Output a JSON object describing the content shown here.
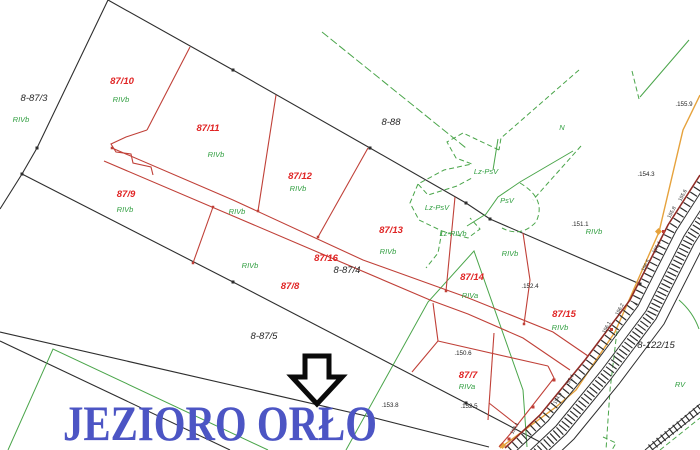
{
  "map": {
    "lake_title": "JEZIORO ORŁO",
    "district_labels": [
      {
        "text": "8-87/3"
      },
      {
        "text": "8-88"
      },
      {
        "text": "8-87/4"
      },
      {
        "text": "8-87/5"
      },
      {
        "text": "8-122/15"
      }
    ],
    "parcel_labels": [
      {
        "text": "87/10"
      },
      {
        "text": "87/11"
      },
      {
        "text": "87/12"
      },
      {
        "text": "87/13"
      },
      {
        "text": "87/9"
      },
      {
        "text": "87/16"
      },
      {
        "text": "87/8"
      },
      {
        "text": "87/14"
      },
      {
        "text": "87/15"
      },
      {
        "text": "87/7"
      }
    ],
    "landuse_labels": [
      {
        "text": "RIVb"
      },
      {
        "text": "RIVb"
      },
      {
        "text": "RIVb"
      },
      {
        "text": "RIVb"
      },
      {
        "text": "RIVb"
      },
      {
        "text": "RIVb"
      },
      {
        "text": "RIVb"
      },
      {
        "text": "RIVb"
      },
      {
        "text": "RIVb"
      },
      {
        "text": "RIVb"
      },
      {
        "text": "RIVb"
      },
      {
        "text": "RIVa"
      },
      {
        "text": "RIVa"
      },
      {
        "text": "Lz-PsV"
      },
      {
        "text": "Lz-PsV"
      },
      {
        "text": "PsV"
      },
      {
        "text": "Lz-RIVb"
      },
      {
        "text": "RV"
      },
      {
        "text": "N"
      }
    ],
    "elevation_points": [
      {
        "text": ".155.9"
      },
      {
        "text": ".154.3"
      },
      {
        "text": ".151.1"
      },
      {
        "text": ".152.4"
      },
      {
        "text": ".150.6"
      },
      {
        "text": ".153.8"
      },
      {
        "text": ".152.5"
      }
    ],
    "track_elevations": [
      {
        "text": "155.6"
      },
      {
        "text": "155.8"
      },
      {
        "text": "156.4"
      },
      {
        "text": "156.5"
      },
      {
        "text": "156.2"
      },
      {
        "text": "156.1"
      },
      {
        "text": "155.4"
      },
      {
        "text": "154.9"
      },
      {
        "text": "154.1"
      }
    ],
    "colors": {
      "line-black": "#2e2e2e",
      "line-red": "#c04038",
      "text-red": "#e02424",
      "line-green": "#4aa54a",
      "text-green": "#2f9e3f",
      "line-orange": "#e6a23c",
      "rail-red": "#8f2b25",
      "title-blue": "#4c55c4"
    }
  }
}
